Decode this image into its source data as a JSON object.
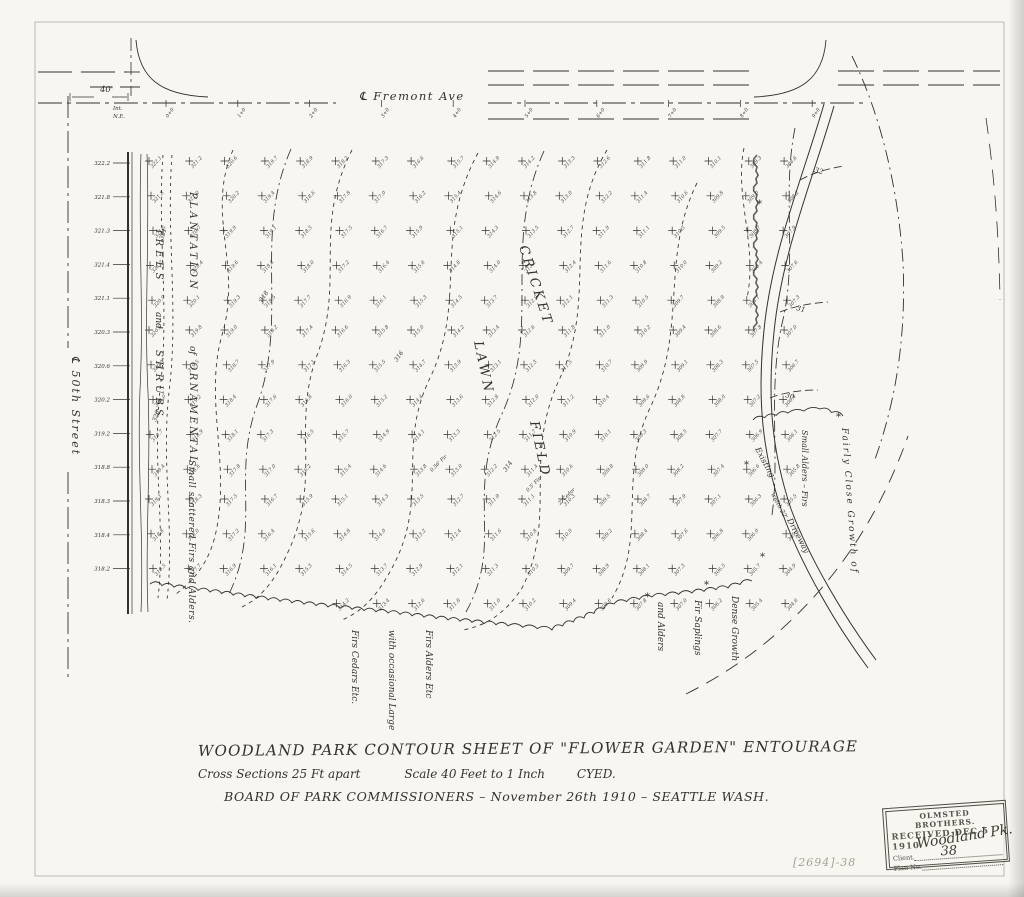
{
  "paper": {
    "bg": "#f7f6f1",
    "ink": "#33322c",
    "pencil": "#a3a198"
  },
  "streets": {
    "fremont_label": "℄ Fremont   Ave",
    "fiftieth_label": "℄  50th  Street",
    "width_dim": "40'",
    "corner_note_line1": "Int.",
    "corner_note_line2": "N.E.",
    "stations": [
      "0+0",
      "1+0",
      "2+0",
      "3+0",
      "4+0",
      "5+0",
      "6+0",
      "7+0",
      "8+0",
      "9+0"
    ]
  },
  "sections_left": [
    "322.2",
    "321.8",
    "321.3",
    "321.4",
    "321.1",
    "320.3",
    "320.6",
    "320.2",
    "319.2",
    "318.8",
    "318.3",
    "318.4",
    "318.2"
  ],
  "field_labels": {
    "cricket": "CRICKET",
    "lawn": "LAWN",
    "field": "FIELD"
  },
  "planting_labels": {
    "plantation": "PLANTATION",
    "of": "of",
    "trees": "TREES",
    "and": "and",
    "ornamental": "ORNAMENTAL",
    "shrubs": "SHRUBS",
    "small_scattered": "Small scattered Firs and Alders."
  },
  "bottom_labels": [
    "Firs Cedars Etc.",
    "with occasional Large",
    "Firs Alders Etc",
    "and Alders",
    "Fir Saplings",
    "Dense Growth"
  ],
  "right_labels": {
    "small_alders": "Small Alders – Firs",
    "fairly_close": "Fairly Close Growth of"
  },
  "road_labels": {
    "existing": "Existing",
    "width": "width 22'",
    "driveway": "Driveway"
  },
  "contour_labels": {
    "left": [
      "321",
      "320"
    ],
    "field": [
      "318",
      "316",
      "314"
    ],
    "road": [
      "32",
      "31",
      "30"
    ]
  },
  "tree_notes": [
    "0.56' Fir",
    "0.5' Fir",
    "2' Cedar"
  ],
  "elevations": {
    "rows": [
      "322.1 321.2 320.6 319.7 318.9 318.2 317.3 316.6 315.7 314.9 314.2 313.3 312.6 311.8 311.0 310.1 309.3 308.6",
      "321.8 321.0 320.2 319.4 318.6 317.8 317.0 316.2 315.4 314.6 313.8 313.0 312.2 311.4 310.6 309.8 309.0 308.2",
      "321.5 320.7 319.9 319.1 318.3 317.5 316.7 315.9 315.1 314.3 313.5 312.7 311.9 311.1 310.3 309.5 308.7 307.9",
      "321.2 320.4 319.6 318.8 318.0 317.2 316.4 315.6 314.8 314.0 313.2 312.4 311.6 310.8 310.0 309.2 308.4 307.6",
      "320.9 320.1 319.3 318.5 317.7 316.9 316.1 315.3 314.5 313.7 312.9 312.1 311.3 310.5 309.7 308.9 308.1 307.3",
      "320.6 319.8 319.0 318.2 317.4 316.6 315.8 315.0 314.2 313.4 312.6 311.8 311.0 310.2 309.4 308.6 307.8 307.0",
      "320.3 319.5 318.7 317.9 317.1 316.3 315.5 314.7 313.9 313.1 312.3 311.5 310.7 309.9 309.1 308.3 307.5 306.7",
      "320.0 319.2 318.4 317.6 316.8 316.0 315.2 314.4 313.6 312.8 312.0 311.2 310.4 309.6 308.8 308.0 307.2 306.4",
      "319.7 318.9 318.1 317.3 316.5 315.7 314.9 314.1 313.3 312.5 311.7 310.9 310.1 309.3 308.5 307.7 306.9 306.1",
      "319.4 318.6 317.8 317.0 316.2 315.4 314.6 313.8 313.0 312.2 311.4 310.6 309.8 309.0 308.2 307.4 306.6 305.8",
      "319.1 318.3 317.5 316.7 315.9 315.1 314.3 313.5 312.7 311.9 311.1 310.3 309.5 308.7 307.9 307.1 306.3 305.5",
      "318.8 318.0 317.2 316.4 315.6 314.8 314.0 313.2 312.4 311.6 310.8 310.0 309.2 308.4 307.6 306.8 306.0 305.2",
      "318.5 317.7 316.9 316.1 315.3 314.5 313.7 312.9 312.1 311.3 310.5 309.7 308.9 308.1 307.3 306.5 305.7 304.9",
      "318.2 317.4 316.6 315.8 315.0 314.2 313.4 312.6 311.8 311.0 310.2 309.4 308.6 307.8 307.0 306.2 305.4 304.6"
    ]
  },
  "title_block": {
    "line1": "WOODLAND PARK   CONTOUR  SHEET  OF  \"FLOWER  GARDEN\"  ENTOURAGE",
    "line2a": "Cross Sections   25 Ft apart",
    "line2b": "Scale 40  Feet  to  1 Inch",
    "line2c": "CYED.",
    "line3": "BOARD  OF  PARK  COMMISSIONERS    –  November 26th 1910  –    SEATTLE   WASH."
  },
  "stamp": {
    "org": "OLMSTED BROTHERS.",
    "received": "RECEIVED  DEC 5 1910",
    "client_label": "Client.",
    "client_value": "Woodland Pk.",
    "plan_label": "Plan No.",
    "plan_value": "38"
  },
  "pencil_note": "[2694]-38"
}
